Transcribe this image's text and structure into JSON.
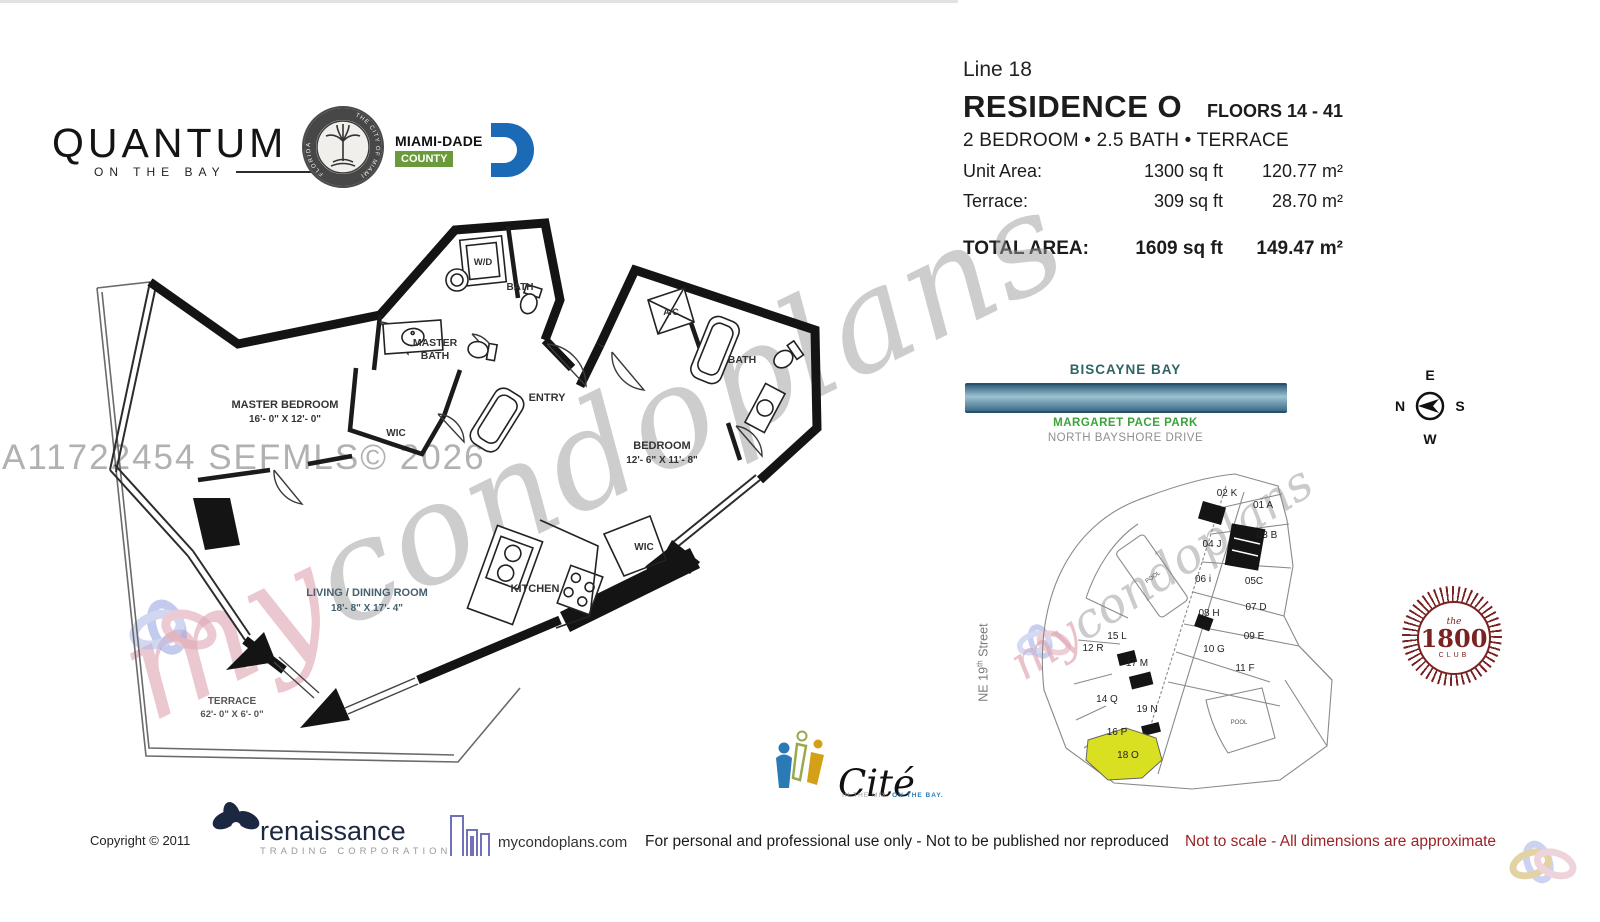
{
  "header": {
    "line_label": "Line 18",
    "residence_title": "RESIDENCE O",
    "floors_label": "FLOORS 14 - 41",
    "subtitle": "2 BEDROOM • 2.5 BATH • TERRACE",
    "unit_area": {
      "label": "Unit Area:",
      "sqft": "1300 sq ft",
      "sqm": "120.77 m²"
    },
    "terrace_area": {
      "label": "Terrace:",
      "sqft": "309 sq ft",
      "sqm": "28.70 m²"
    },
    "total_area": {
      "label": "TOTAL AREA:",
      "sqft": "1609 sq ft",
      "sqm": "149.47 m²"
    }
  },
  "branding": {
    "quantum": {
      "title": "QUANTUM",
      "subtitle": "ON THE BAY"
    },
    "seal": {
      "text_top": "THE CITY OF MIAMI",
      "text_bottom": "FLORIDA"
    },
    "miamidade": {
      "name": "MIAMI-DADE",
      "county": "COUNTY",
      "d_color": "#1a6ab5",
      "county_color": "#6a9a3a"
    }
  },
  "floorplan": {
    "labels": {
      "master_bedroom": "MASTER BEDROOM",
      "master_bedroom_dims": "16'- 0\" X 12'- 0\"",
      "master_bath_1": "MASTER",
      "master_bath_2": "BATH",
      "wic_master": "WIC",
      "entry": "ENTRY",
      "bath_powder": "BATH",
      "wd": "W/D",
      "ac": "A/C",
      "bedroom": "BEDROOM",
      "bedroom_dims": "12'- 6\" X 11'- 8\"",
      "bath_bedroom": "BATH",
      "wic_kitchen": "WIC",
      "living": "LIVING / DINING ROOM",
      "living_dims": "18'- 8\" X 17'- 4\"",
      "kitchen": "KITCHEN",
      "terrace": "TERRACE",
      "terrace_dims": "62'- 0\" X 6'- 0\""
    }
  },
  "watermarks": {
    "mls_text": "A11722454  SEFMLS© 2026",
    "script_prefix": "my",
    "script_body": "condoplans"
  },
  "sitemap": {
    "bay_label": "BISCAYNE BAY",
    "park_label": "MARGARET PACE PARK",
    "drive_label": "NORTH BAYSHORE DRIVE",
    "street_prefix": "NE 19",
    "street_sup": "th",
    "street_suffix": "Street",
    "pool_label": "POOL",
    "units": [
      "02 K",
      "01 A",
      "03 B",
      "04 J",
      "06 i",
      "05C",
      "08 H",
      "07 D",
      "09 E",
      "10 G",
      "11 F",
      "15 L",
      "12 R",
      "17 M",
      "14 Q",
      "19 N",
      "16 P",
      "18 O"
    ],
    "highlighted_unit": "18 O",
    "highlight_color": "#d9e021"
  },
  "compass": {
    "top": "E",
    "left": "N",
    "right": "S",
    "bottom": "W"
  },
  "club1800": {
    "the": "the",
    "number": "1800",
    "club": "CLUB"
  },
  "cite": {
    "name": "Cité",
    "tagline_gray": "IN THE MIX.",
    "tagline_blue": "ON THE BAY."
  },
  "footer": {
    "copyright": "Copyright ©  2011",
    "renaissance": "renaissance",
    "renaissance_sub": "TRADING CORPORATION",
    "website": "mycondoplans.com",
    "usage": "For personal and professional use only - Not to be published nor reproduced",
    "scale_note": "Not to scale - All dimensions are approximate"
  }
}
